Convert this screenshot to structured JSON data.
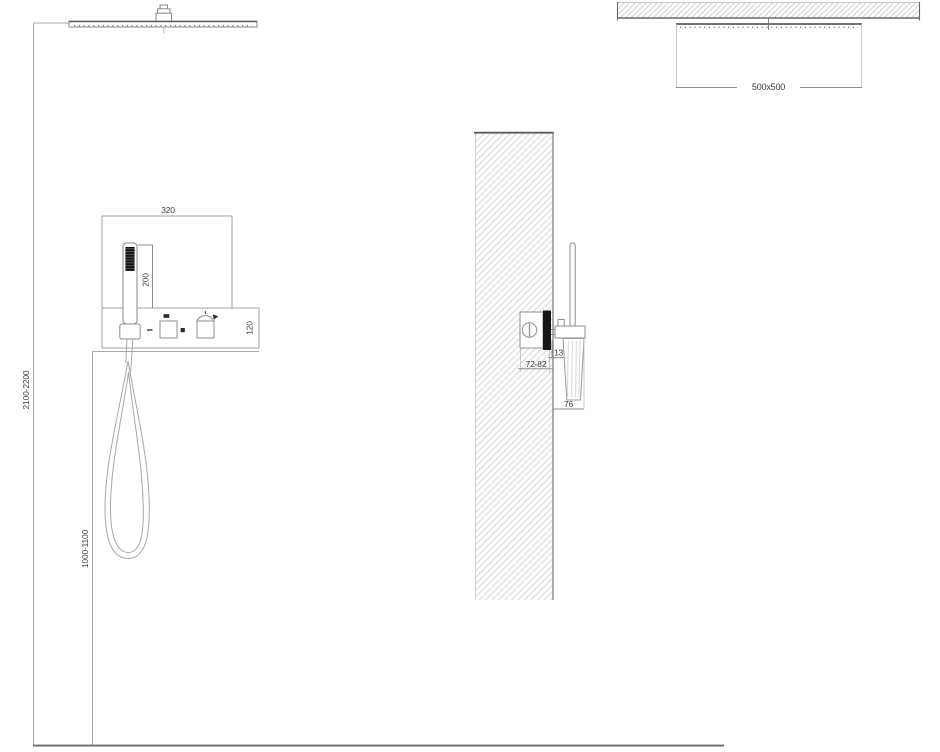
{
  "views": {
    "front": {
      "labels": {
        "panel_width": "320",
        "handset_length": "200",
        "panel_band_height": "120",
        "overhead_height_range": "2100-2200",
        "handset_height_range": "1000-1100"
      }
    },
    "side": {
      "labels": {
        "valve_recess_depth": "72-82",
        "trim_plate_thickness": "13",
        "handle_wall_offset": "76"
      }
    },
    "ceiling_plan": {
      "labels": {
        "head_size": "500x500"
      }
    }
  },
  "icons": {
    "flow_minus": "dash-icon",
    "diverter_square": "square-icon",
    "dot_separator": "dot-icon",
    "temperature_dial": "rotary-arrow-icon"
  },
  "colors": {
    "background": "#ffffff",
    "line_light": "#a8a8a8",
    "line_medium": "#8f8f8f",
    "line_dark": "#5e5e5e",
    "fill_dark": "#161616",
    "hatch": "#d2d2d2",
    "text": "#3f3f3f"
  }
}
